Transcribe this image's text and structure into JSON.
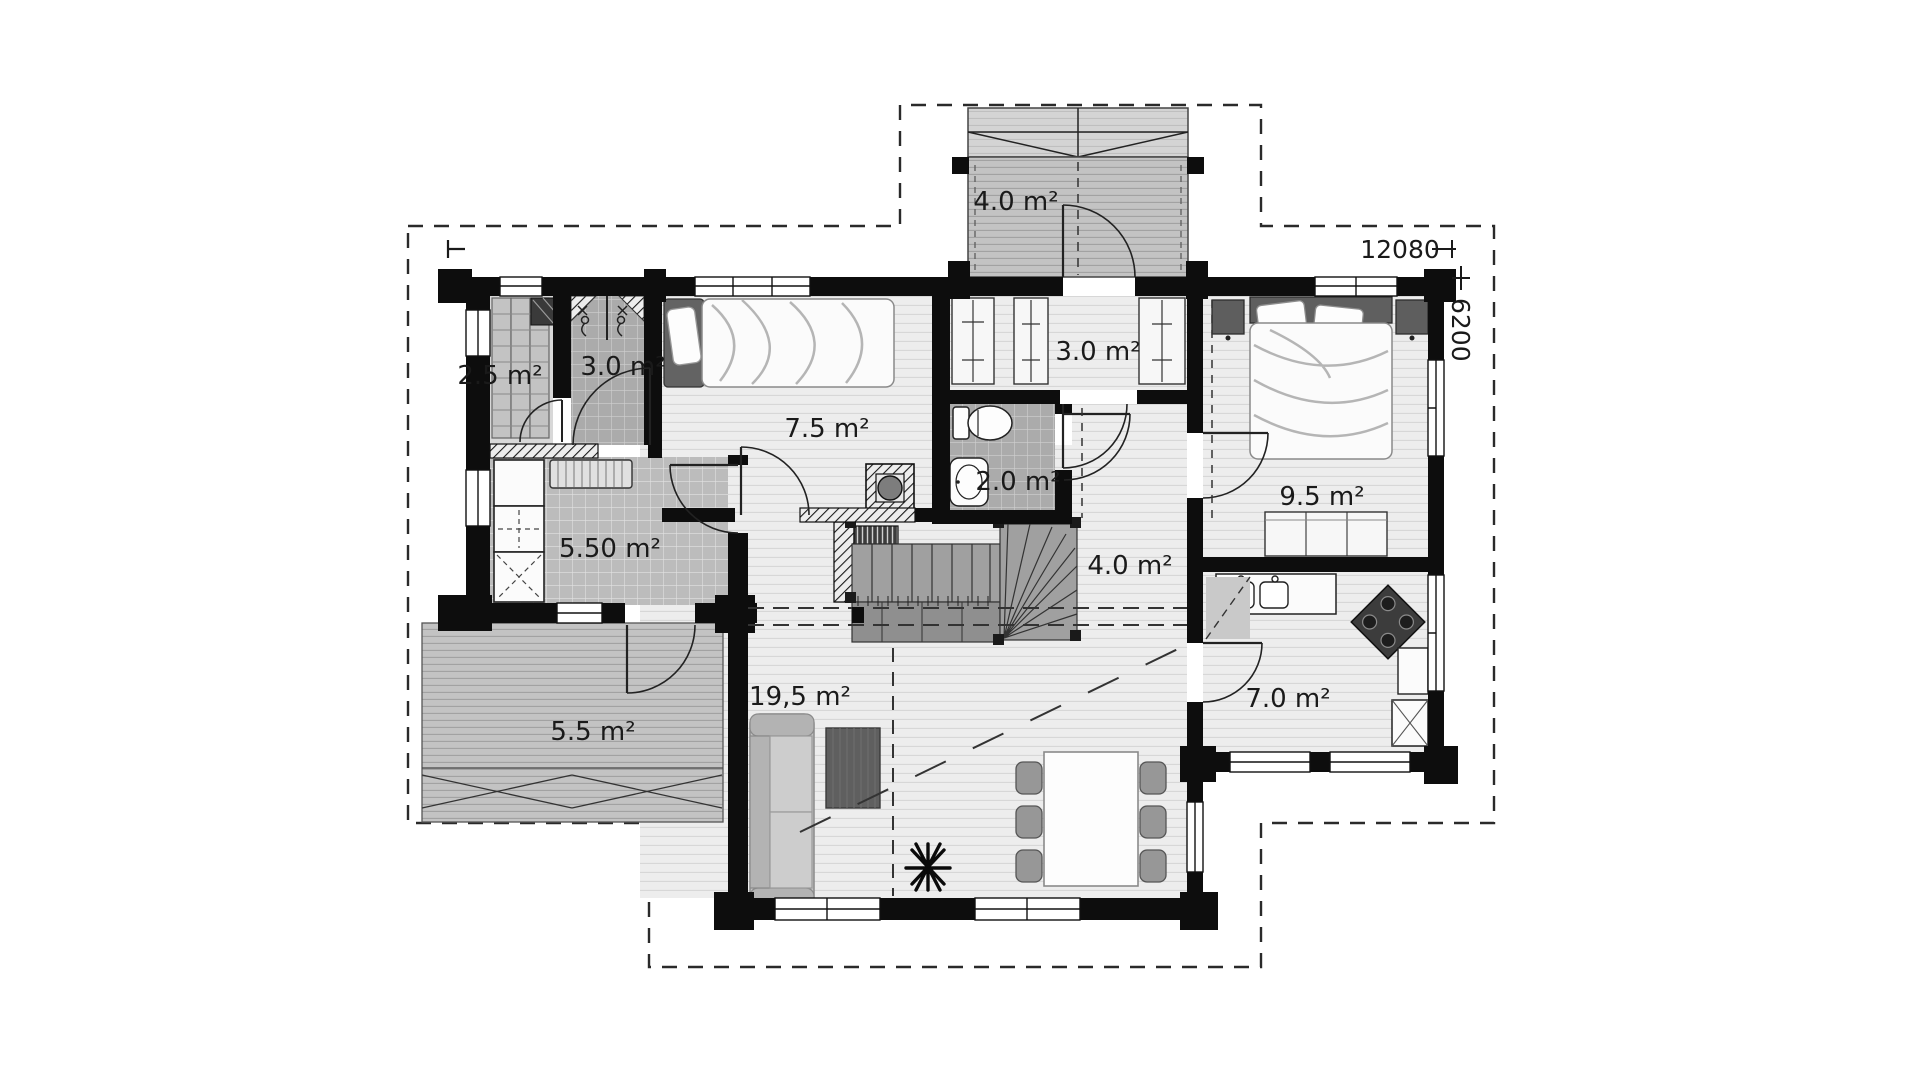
{
  "floor_plan": {
    "type": "house-ground-floor-plan",
    "rooms": [
      {
        "id": "entrance-porch",
        "area_label": "4.0 m²"
      },
      {
        "id": "sauna",
        "area_label": "2.5 m²"
      },
      {
        "id": "shower-room",
        "area_label": "3.0 m²"
      },
      {
        "id": "bedroom-small",
        "area_label": "7.5 m²"
      },
      {
        "id": "entry-closet",
        "area_label": "3.0 m²"
      },
      {
        "id": "wc",
        "area_label": "2.0 m²"
      },
      {
        "id": "utility-room",
        "area_label": "5.50 m²"
      },
      {
        "id": "hall",
        "area_label": "4.0 m²"
      },
      {
        "id": "bedroom-master",
        "area_label": "9.5 m²"
      },
      {
        "id": "terrace",
        "area_label": "5.5 m²"
      },
      {
        "id": "living-room",
        "area_label": "19,5 m²"
      },
      {
        "id": "kitchen",
        "area_label": "7.0 m²"
      }
    ],
    "dimensions": {
      "width_mm": "12080",
      "depth_mm": "6200"
    },
    "colors": {
      "wall": "#0d0d0d",
      "floor_light": "#ededed",
      "tile_gray": "#ababab",
      "tile_utility": "#bcbcbc",
      "deck_gray": "#c3c3c3",
      "background": "#ffffff"
    }
  }
}
